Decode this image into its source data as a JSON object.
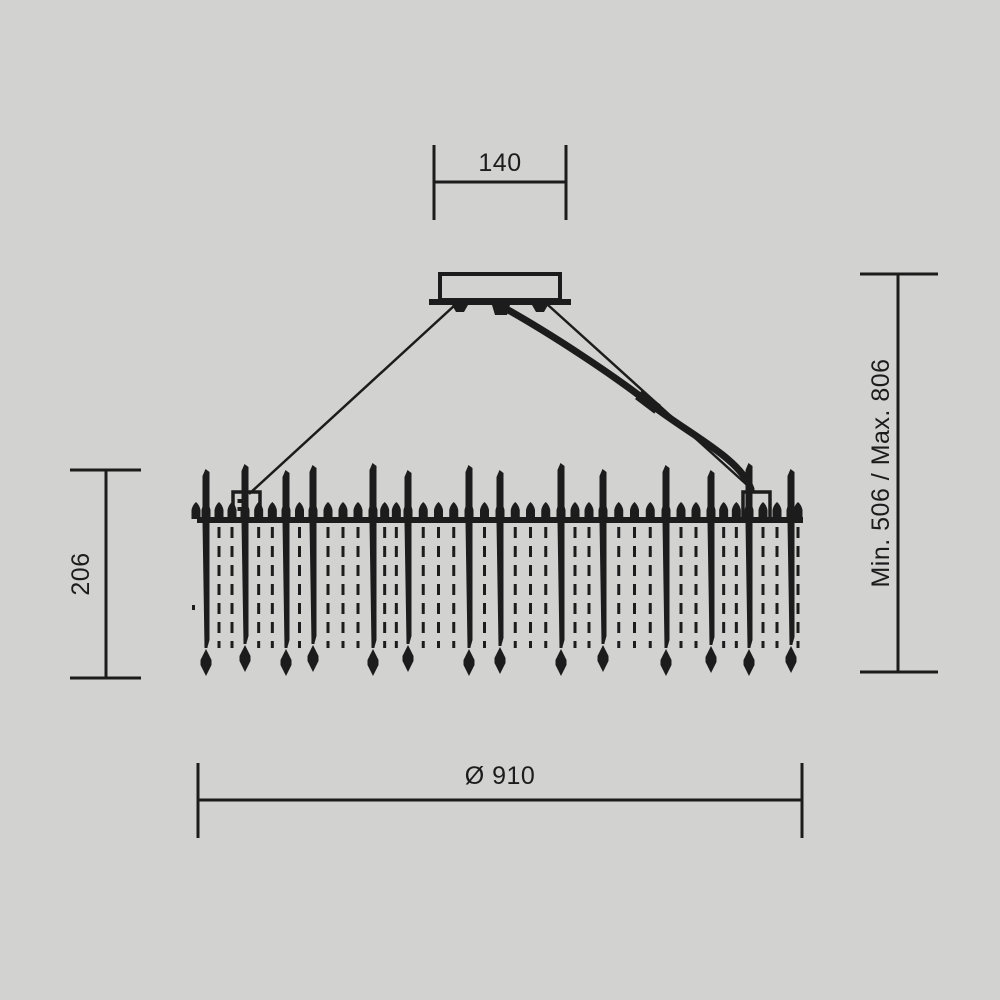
{
  "title": "chandelier-dimension-diagram",
  "colors": {
    "background": "#d2d2d1",
    "ink": "#1c1c1c"
  },
  "dimensions": {
    "canopy_width": {
      "label": "140",
      "orientation": "h",
      "y": 182,
      "x1": 434,
      "x2": 566,
      "tick1": 145,
      "tick2": 220,
      "label_x": 500,
      "label_y": 171
    },
    "fixture_height": {
      "label": "206",
      "orientation": "v",
      "x": 106,
      "y1": 470,
      "y2": 678,
      "tick1": 70,
      "tick2": 141,
      "label_x": 89,
      "label_y": 574
    },
    "suspension_height": {
      "label": "Min. 506 / Max. 806",
      "orientation": "v",
      "x": 898,
      "y1": 274,
      "y2": 672,
      "tick1": 860,
      "tick2": 938,
      "label_x": 889,
      "label_y": 473
    },
    "diameter": {
      "label": "Ø 910",
      "orientation": "h",
      "y": 800,
      "x1": 198,
      "x2": 802,
      "tick1": 763,
      "tick2": 838,
      "label_x": 500,
      "label_y": 784
    }
  },
  "figure": {
    "stroke": {
      "dim": 3,
      "wire": 2.5,
      "cable": 7,
      "outline": 4
    },
    "canopy": {
      "body": {
        "x": 440,
        "y": 274,
        "w": 120,
        "h": 26
      },
      "base": {
        "x": 429,
        "y": 299,
        "w": 142,
        "h": 6
      },
      "stub": [
        [
          492,
          305
        ],
        [
          510,
          305
        ],
        [
          507,
          315
        ],
        [
          495,
          315
        ]
      ],
      "feet": [
        [
          [
            452,
            305
          ],
          [
            468,
            305
          ],
          [
            464,
            312
          ],
          [
            456,
            312
          ]
        ],
        [
          [
            532,
            305
          ],
          [
            548,
            305
          ],
          [
            544,
            312
          ],
          [
            536,
            312
          ]
        ]
      ]
    },
    "wires": [
      {
        "x1": 455,
        "y1": 305,
        "x2": 249,
        "y2": 494
      },
      {
        "x1": 548,
        "y1": 305,
        "x2": 756,
        "y2": 493
      }
    ],
    "cable": {
      "path": "M 501 306 C 548 332 612 374 649 403 C 690 435 740 458 751 489",
      "connector": {
        "cx": 648,
        "cy": 402,
        "w": 24,
        "h": 11,
        "angle": 37
      }
    },
    "ring": {
      "x1": 197,
      "x2": 803,
      "y": 517,
      "h": 6
    },
    "rod_width": 7,
    "rods": [
      {
        "x": 206,
        "top": 469,
        "tip": 676
      },
      {
        "x": 245,
        "top": 464,
        "tip": 672
      },
      {
        "x": 286,
        "top": 470,
        "tip": 676
      },
      {
        "x": 313,
        "top": 465,
        "tip": 672
      },
      {
        "x": 373,
        "top": 463,
        "tip": 676
      },
      {
        "x": 408,
        "top": 470,
        "tip": 672
      },
      {
        "x": 469,
        "top": 465,
        "tip": 676
      },
      {
        "x": 500,
        "top": 470,
        "tip": 674
      },
      {
        "x": 561,
        "top": 463,
        "tip": 676
      },
      {
        "x": 603,
        "top": 469,
        "tip": 672
      },
      {
        "x": 666,
        "top": 465,
        "tip": 676
      },
      {
        "x": 711,
        "top": 470,
        "tip": 673
      },
      {
        "x": 749,
        "top": 463,
        "tip": 676
      },
      {
        "x": 791,
        "top": 469,
        "tip": 673
      }
    ],
    "strand_counts": [
      2,
      2,
      1,
      3,
      2,
      3,
      1,
      3,
      2,
      3,
      2,
      2,
      2
    ],
    "edge_strands": [
      798
    ],
    "edge_beads": [
      196,
      798
    ],
    "strand": {
      "top": 527,
      "bottom": 648,
      "width": 3,
      "dash": "11 8"
    },
    "bead": {
      "w": 9,
      "h": 17
    },
    "brackets": [
      {
        "x": 233,
        "y": 492,
        "w": 27,
        "h": 27
      },
      {
        "x": 743,
        "y": 492,
        "w": 27,
        "h": 27
      }
    ],
    "stray_dot": {
      "x": 192,
      "y": 605,
      "w": 3,
      "h": 5
    }
  }
}
